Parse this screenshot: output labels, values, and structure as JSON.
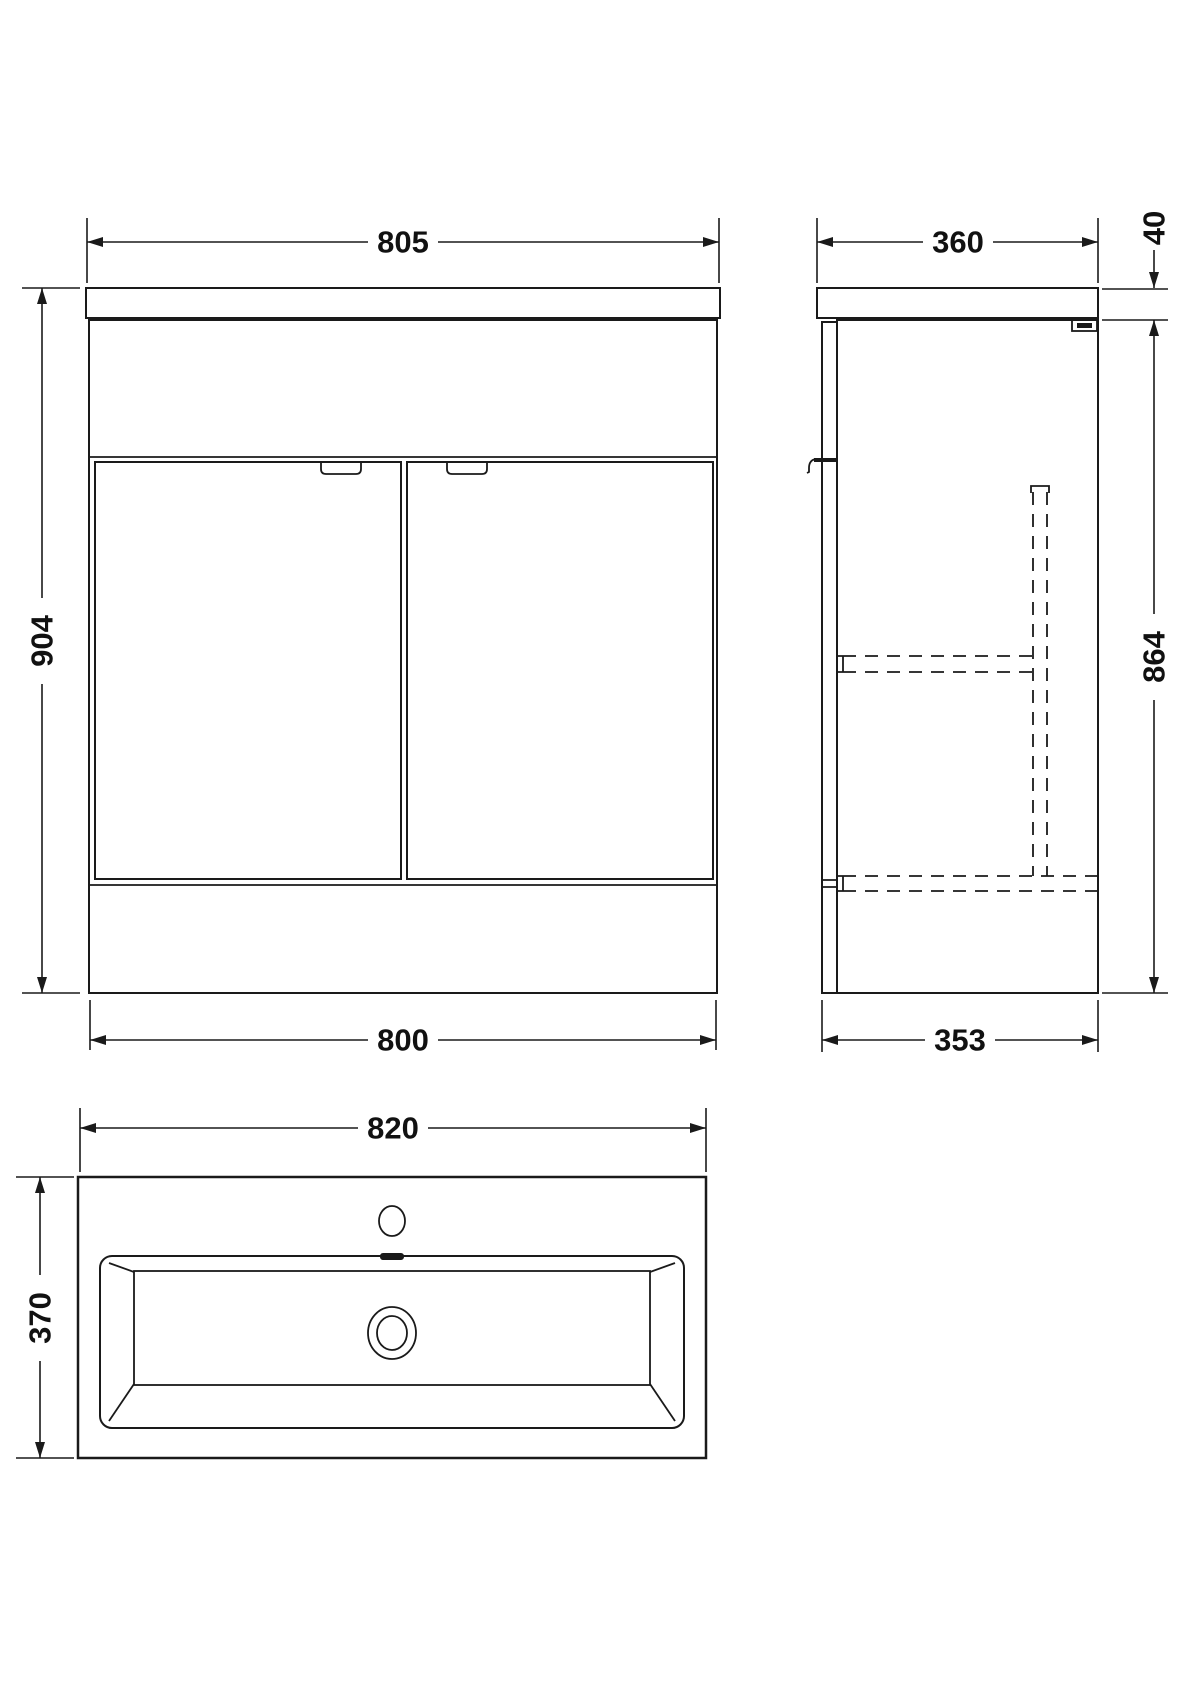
{
  "views": {
    "front": {
      "dims": {
        "width_top": "805",
        "height": "904",
        "width_bottom": "800"
      }
    },
    "side": {
      "dims": {
        "depth_top": "360",
        "worktop_thickness": "40",
        "cabinet_height": "864",
        "depth_bottom": "353"
      }
    },
    "basin": {
      "dims": {
        "width": "820",
        "depth": "370"
      }
    }
  },
  "colors": {
    "line": "#1a1a1a",
    "background": "#ffffff"
  }
}
